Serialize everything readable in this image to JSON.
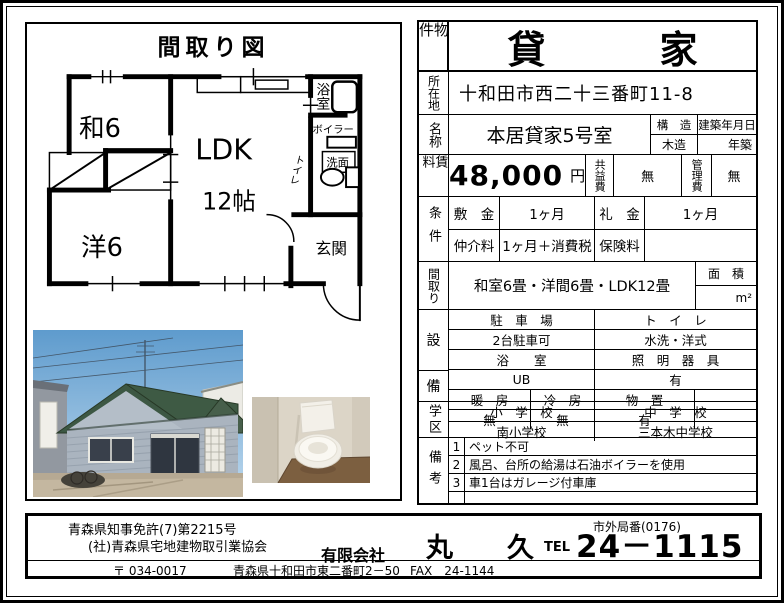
{
  "floorplan": {
    "title": "間取り図",
    "rooms": {
      "washitsu": "和6",
      "western": "洋6",
      "ldk": "LDK",
      "ldk_size": "12帖",
      "bath": "浴室",
      "boiler": "ボイラー",
      "washstand": "洗面",
      "toilet": "トイレ",
      "entrance": "玄関"
    }
  },
  "table": {
    "property_label": "物件",
    "property_type": "貸　　　家",
    "location_label": "所在地",
    "location": "十和田市西二十三番町11-8",
    "name_label": "名称",
    "name": "本居貸家5号室",
    "structure_label": "構　造",
    "structure": "木造",
    "built_label": "建築年月日",
    "built": "年築",
    "rent_label": "賃料",
    "rent": "48,000",
    "rent_unit": "円",
    "common_fee_label": "共益費",
    "common_fee": "無",
    "mgmt_fee_label": "管理費",
    "mgmt_fee": "無",
    "terms_label": "条件",
    "deposit_label": "敷　金",
    "deposit": "1ヶ月",
    "key_money_label": "礼　金",
    "key_money": "1ヶ月",
    "agent_fee_label": "仲介料",
    "agent_fee": "1ヶ月＋消費税",
    "insurance_label": "保険料",
    "insurance": "",
    "layout_label": "間取り",
    "layout": "和室6畳・洋間6畳・LDK12畳",
    "area_label": "面　積",
    "area_unit": "m²",
    "equip_label_upper": "設",
    "equip_label_lower": "備",
    "parking_label": "駐　車　場",
    "parking": "2台駐車可",
    "toilet_label": "ト　イ　レ",
    "toilet": "水洗・洋式",
    "bath_label": "浴　　室",
    "bath": "UB",
    "lighting_label": "照　明　器　具",
    "lighting": "有",
    "heating_label": "暖　房",
    "heating": "無",
    "cooling_label": "冷　房",
    "cooling": "無",
    "storage_label": "物　置",
    "storage": "有",
    "storage_extra": "",
    "school_label": "学区",
    "elementary_label": "小　学　校",
    "elementary": "南小学校",
    "junior_label": "中　学　校",
    "junior": "三本木中学校",
    "notes_label": "備考",
    "notes": [
      {
        "no": "1",
        "text": "ペット不可"
      },
      {
        "no": "2",
        "text": "風呂、台所の給湯は石油ボイラーを使用"
      },
      {
        "no": "3",
        "text": "車1台はガレージ付車庫"
      },
      {
        "no": "",
        "text": ""
      }
    ]
  },
  "footer": {
    "license1": "青森県知事免許(7)第2215号",
    "license2": "(社)青森県宅地建物取引業協会",
    "area_code": "市外局番(0176)",
    "company_prefix": "有限会社",
    "company_name": "丸　　久",
    "tel_label": "TEL",
    "tel": "24－1115",
    "postal": "〒 034-0017",
    "address": "青森県十和田市東二番町2－50",
    "fax": "FAX　24-1144"
  }
}
